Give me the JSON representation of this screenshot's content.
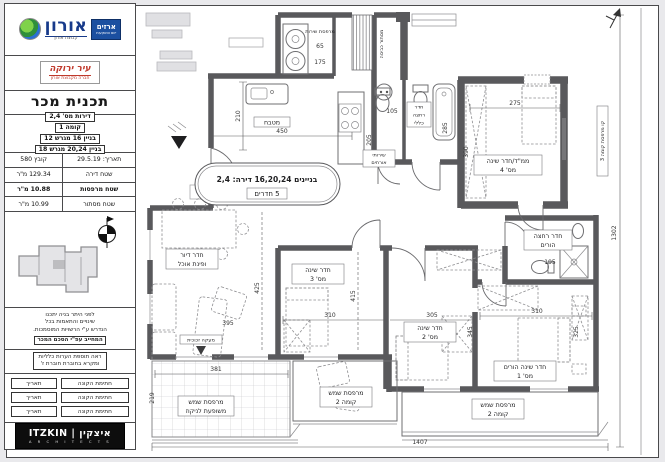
{
  "title_block": {
    "logo_primary": {
      "name": "אורון",
      "sub": "קבוצת אורון",
      "tag": "ארזים",
      "tag_sub": "יזום והשקעות"
    },
    "logo_secondary": {
      "name": "עיר ירוקה",
      "caption": "חברה מקבוצת אורון"
    },
    "doc_title": "תכנית מכר",
    "info_lines": [
      "דירות מס' 2,4",
      "קומה 1",
      "בניין 16 מגרש 12",
      "בניין 20,24 מגרש 18"
    ],
    "table": {
      "rows": [
        {
          "label": "תאריך: 29.5.19",
          "value": "קובץ 580"
        },
        {
          "label": "שטח דירה",
          "value": "129.34 מ\"ר"
        },
        {
          "label": "שטח מרפסות",
          "value": "10.88 מ\"ר"
        },
        {
          "label": "שטח מסתור",
          "value": "10.99 מ\"ר"
        }
      ]
    },
    "notes": [
      "לפני היתר בניה יתכנו",
      "שינויים והתאמות בכל",
      "הנדרש ע\"י הרשויות המוסמכות.",
      "המחייב עפ\"י הסכם המכר"
    ],
    "general_note": [
      "ראה תוספת הערות כלליות",
      "ומקרא בחוברת חוברת ז'"
    ],
    "signature_rows": [
      {
        "label": "חתימת הקונה",
        "value": "תאריך"
      },
      {
        "label": "חתימת הקונה",
        "value": "תאריך"
      },
      {
        "label": "חתימת הקונה",
        "value": "תאריך"
      }
    ],
    "architect": {
      "name": "ITZKIN | איצקין",
      "sub": "A R C H I T E C T S"
    }
  },
  "plan": {
    "oval": {
      "line1": "בניינים 16,20,24 דירה: 2,4",
      "line2": "5 חדרים"
    },
    "rooms": {
      "kitchen": "מטבח",
      "service_balcony": "מרפסת שירות",
      "guest_wc_1": "שירותי",
      "guest_wc_2": "אורחים",
      "bath_1": "חדר",
      "bath_2": "רחצה",
      "bath_3": "כללי",
      "mamad_1": "ממ\"ד/חדר שינה",
      "mamad_2": "מס' 4",
      "parents_bath_1": "חדר רחצה",
      "parents_bath_2": "הורים",
      "bed3_1": "חדר שינה",
      "bed3_2": "מס' 3",
      "bed2_1": "חדר שינה",
      "bed2_2": "מס' 2",
      "bed1_1": "חדר שינה הורים",
      "bed1_2": "מס' 1",
      "living_1": "חדר דיור",
      "living_2": "ופינת אוכל",
      "balcony_left_1": "מרפסת שמש",
      "balcony_left_2": "משופעת לניקוז",
      "balcony_mid_1": "מרפסת שמש",
      "balcony_mid_2": "קומה 2",
      "balcony_right_1": "מרפסת שמש",
      "balcony_right_2": "קומה 2"
    },
    "annotations": {
      "laundry_screen": "מסתור כביסה",
      "balcony_line": "קו מרפסת קומה 3",
      "railing": "מעקה זכוכית"
    },
    "dims": {
      "k_w": "450",
      "k_h": "210",
      "sb_a": "65",
      "sb_b": "175",
      "wc_w": "105",
      "wc_h": "205",
      "bath_w": "158",
      "bath_h": "285",
      "mamad_w": "275",
      "mamad_h": "390",
      "pb_w": "195",
      "pb_h": "172",
      "b3_w": "310",
      "b3_h": "415",
      "b2_w": "305",
      "b1_w": "310",
      "b1_h": "325",
      "hall_h": "345",
      "lv_w": "395",
      "lv_h": "425",
      "bl_w": "381",
      "bl_h": "219",
      "total_w": "1407",
      "total_h": "1302"
    }
  }
}
